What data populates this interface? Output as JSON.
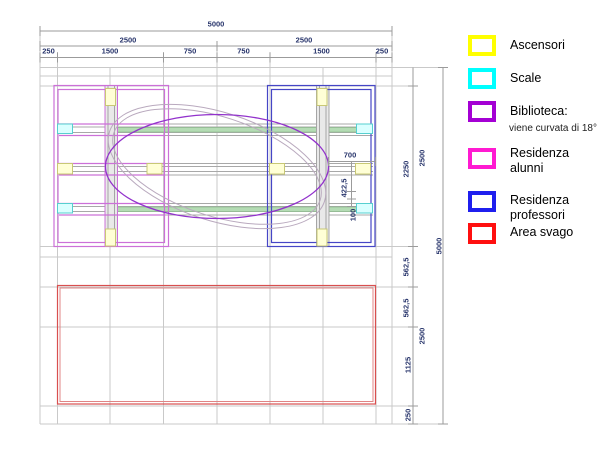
{
  "dimensions": {
    "top": {
      "total": "5000",
      "halves": [
        "2500",
        "2500"
      ],
      "segments": [
        "250",
        "1500",
        "750",
        "750",
        "1500",
        "250"
      ]
    },
    "right": {
      "segments": [
        "2250",
        "562,5",
        "562,5",
        "1125",
        "250"
      ],
      "halves": [
        "2500",
        "2500"
      ],
      "total": "5000"
    },
    "interior": {
      "width_a": "700",
      "height_b": "422,5",
      "height_c": "100"
    }
  },
  "legend": {
    "items": [
      {
        "label": "Ascensori",
        "color": "#ffff00"
      },
      {
        "label": "Scale",
        "color": "#00ffff"
      },
      {
        "label": "Biblioteca:",
        "sublabel": "viene curvata di 18°",
        "color": "#a400d4"
      },
      {
        "label": "Residenza alunni",
        "color": "#ff1ad1"
      },
      {
        "label": "Residenza professori",
        "color": "#1f1fee"
      },
      {
        "label": "Area svago",
        "color": "#ff0f0f"
      }
    ]
  },
  "plan_colors": {
    "residenza_alunni_walls": "#cc70d8",
    "residenza_professori_walls": "#4646c6",
    "biblioteca_ellipse": "#9232cc",
    "biblioteca_rotated_shell": "#b9a9be",
    "area_svago_border": "#d94f4f",
    "ascensori_fill": "#ffffd6",
    "scale_fill": "#daffff",
    "walkway_green": "#b4dcb4",
    "grid": "#c9c9c9",
    "dimension_lines": "#9b9b9b",
    "dimension_text": "#27346b"
  }
}
